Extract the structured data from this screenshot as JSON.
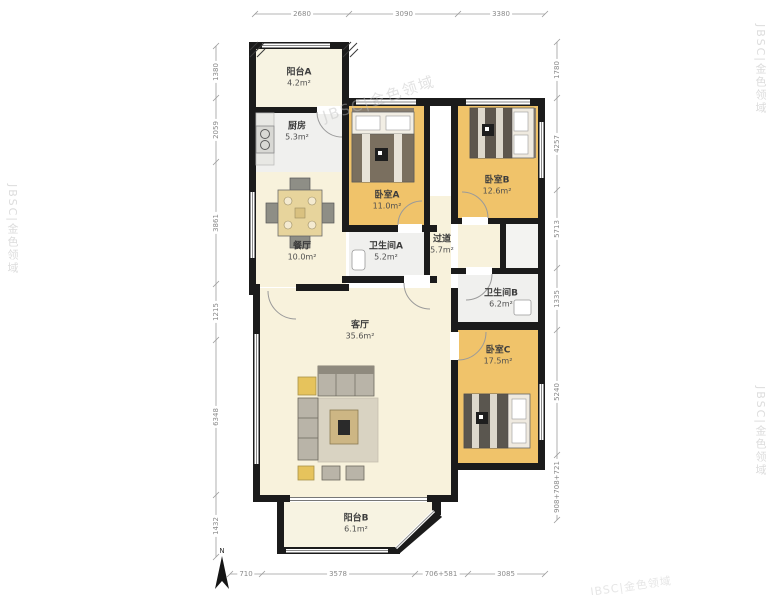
{
  "plan": {
    "rooms": {
      "balcony_a": {
        "name": "阳台A",
        "area": "4.2m²"
      },
      "kitchen": {
        "name": "厨房",
        "area": "5.3m²"
      },
      "dining": {
        "name": "餐厅",
        "area": "10.0m²"
      },
      "bedroom_a": {
        "name": "卧室A",
        "area": "11.0m²"
      },
      "bedroom_b": {
        "name": "卧室B",
        "area": "12.6m²"
      },
      "bath_a": {
        "name": "卫生间A",
        "area": "5.2m²"
      },
      "hallway": {
        "name": "过道",
        "area": "5.7m²"
      },
      "bath_b": {
        "name": "卫生间B",
        "area": "6.2m²"
      },
      "living": {
        "name": "客厅",
        "area": "35.6m²"
      },
      "bedroom_c": {
        "name": "卧室C",
        "area": "17.5m²"
      },
      "balcony_b": {
        "name": "阳台B",
        "area": "6.1m²"
      }
    },
    "dimensions": {
      "top": [
        "2680",
        "3090",
        "3380"
      ],
      "bottom": [
        "710",
        "3578",
        "706+581",
        "3085"
      ],
      "left": [
        "1380",
        "2059",
        "3861",
        "1215",
        "6348",
        "1432"
      ],
      "right": [
        "1780",
        "4257",
        "5713",
        "1335",
        "5240",
        "908+708+721"
      ]
    },
    "compass": "N",
    "watermark": "JBSC|金色领域",
    "colors": {
      "wall": "#1b1b1b",
      "bedroom_floor": "#f0c36a",
      "living_floor": "#f8f2dc",
      "wet_floor": "#f0f0ee",
      "balcony_floor": "#f7f3e2"
    }
  }
}
